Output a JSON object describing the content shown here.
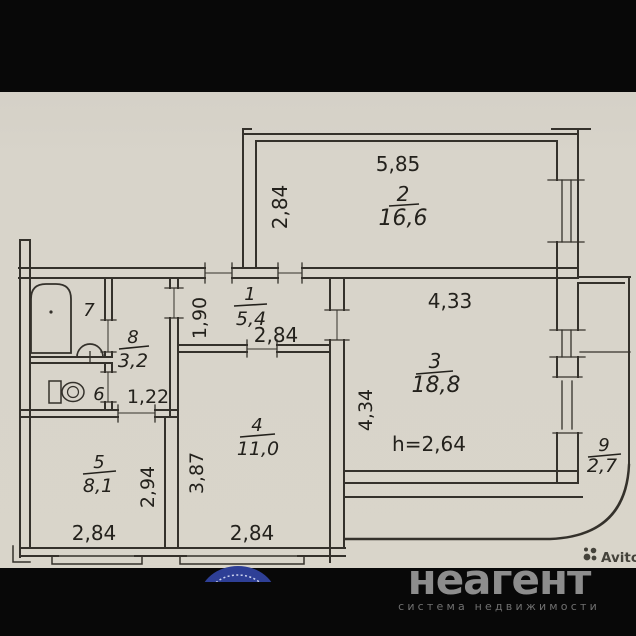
{
  "watermark": {
    "brand": "неагент",
    "tagline": "система недвижимости",
    "avito_label": "Avito"
  },
  "rooms": {
    "room1": {
      "num": "1",
      "area": "5,4"
    },
    "room2": {
      "num": "2",
      "area": "16,6"
    },
    "room3": {
      "num": "3",
      "area": "18,8"
    },
    "room4": {
      "num": "4",
      "area": "11,0"
    },
    "room5": {
      "num": "5",
      "area": "8,1"
    },
    "room6": {
      "num": "6"
    },
    "room7": {
      "num": "7"
    },
    "room8": {
      "num": "8",
      "area": "3,2"
    },
    "room9": {
      "num": "9",
      "area": "2,7"
    }
  },
  "dims": {
    "room2_width": "5,85",
    "room2_depth": "2,84",
    "hall_width": "2,84",
    "hall_depth": "1,90",
    "room3_width": "4,33",
    "room3_depth": "4,34",
    "ceiling_height": "h=2,64",
    "wc_width": "1,22",
    "room4_depth": "3,87",
    "room5_depth": "2,94",
    "room5_width": "2,84",
    "room4_width": "2,84"
  },
  "colors": {
    "paper": "#d6d2c8",
    "band": "#080808",
    "line": "#34312b",
    "brand_grey": "#8d8d8d",
    "stamp_blue": "#2e3f96"
  }
}
